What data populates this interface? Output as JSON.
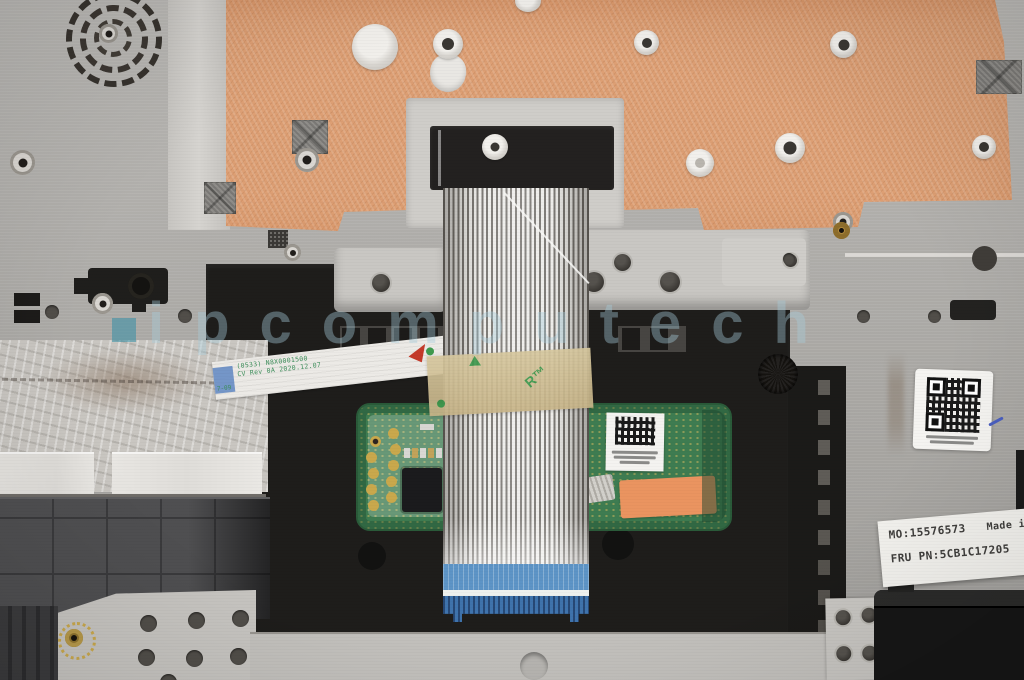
{
  "watermark": {
    "text": "ipcomputech"
  },
  "fru_label": {
    "mo": "MO:15576573",
    "made_in": "Made in Ch",
    "fru": "FRU PN:5CB1C17205",
    "handwritten": "HS"
  },
  "ffc_sticker": {
    "line1": "(0533) N8X0001500",
    "line2": "CV Rev 0A 2020.12.07",
    "edge_mark": "7-09"
  },
  "tape_marking": "R™",
  "colors": {
    "copper_sheet": "#dd9f74",
    "palmrest_metal": "#b6b4b0",
    "pcb_green": "#3e7c51",
    "tape_tan": "#cdbb90",
    "stiffener_blue": "#4a84bd",
    "orange_sticker": "#ea9460",
    "watermark_blue": "#a8cddd",
    "frame_black": "#1e1d1b"
  }
}
